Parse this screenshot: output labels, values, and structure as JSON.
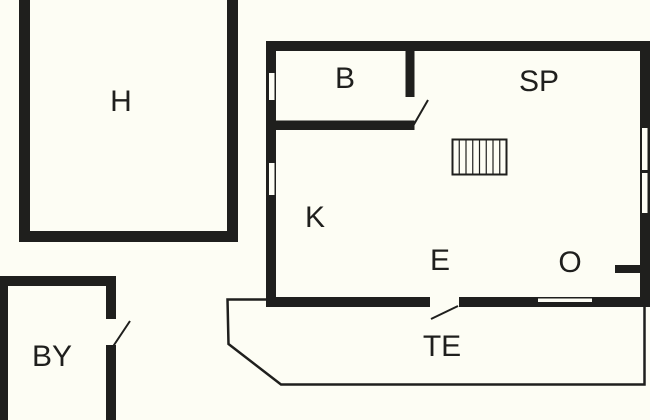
{
  "plan_type": "floor-plan",
  "colors": {
    "wall": "#1f1f1d",
    "floor": "#fdfdf4"
  },
  "rooms": {
    "h": {
      "label": "H"
    },
    "b": {
      "label": "B"
    },
    "sp": {
      "label": "SP"
    },
    "k": {
      "label": "K"
    },
    "e": {
      "label": "E"
    },
    "o": {
      "label": "O"
    },
    "te": {
      "label": "TE"
    },
    "by": {
      "label": "BY"
    }
  },
  "stairs": {
    "treads": 8
  }
}
